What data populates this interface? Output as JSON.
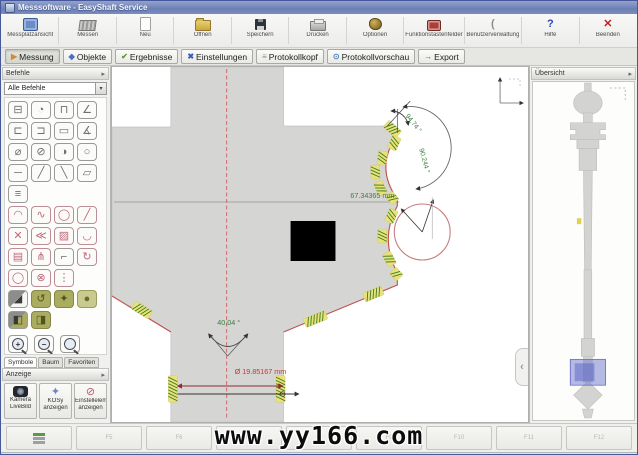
{
  "window": {
    "title": "Messsoftware - EasyShaft Service"
  },
  "toolbar": {
    "items": [
      {
        "id": "messplatzansicht",
        "label": "Messplatzansicht",
        "icon": "monitor"
      },
      {
        "id": "messen",
        "label": "Messen",
        "icon": "ruler"
      },
      {
        "id": "neu",
        "label": "Neu",
        "icon": "page"
      },
      {
        "id": "oeffnen",
        "label": "Öffnen",
        "icon": "folder"
      },
      {
        "id": "speichern",
        "label": "Speichern",
        "icon": "floppy"
      },
      {
        "id": "drucken",
        "label": "Drucken",
        "icon": "printer"
      },
      {
        "id": "optionen",
        "label": "Optionen",
        "icon": "gear"
      },
      {
        "id": "funktionstastenfelder",
        "label": "Funktionstastenfelder",
        "icon": "keypad"
      },
      {
        "id": "benutzerverwaltung",
        "label": "Benutzerverwaltung",
        "icon": "user",
        "glyph": "(",
        "gcls": "g-user"
      },
      {
        "id": "hilfe",
        "label": "Hilfe",
        "icon": "help",
        "glyph": "?",
        "gcls": "g-help"
      },
      {
        "id": "beenden",
        "label": "Beenden",
        "icon": "exit",
        "glyph": "✕",
        "gcls": "g-exit"
      }
    ]
  },
  "tabs": {
    "items": [
      {
        "id": "messung",
        "label": "Messung",
        "glyph": "▶",
        "color": "#cf8a3a",
        "active": true
      },
      {
        "id": "objekte",
        "label": "Objekte",
        "glyph": "◆",
        "color": "#4a6fc0",
        "active": false
      },
      {
        "id": "ergebnisse",
        "label": "Ergebnisse",
        "glyph": "✔",
        "color": "#5a9a3a",
        "active": false
      },
      {
        "id": "einstellungen",
        "label": "Einstellungen",
        "glyph": "✖",
        "color": "#3a5fc0",
        "active": false
      },
      {
        "id": "protokollkopf",
        "label": "Protokollkopf",
        "glyph": "≡",
        "color": "#8a8a88",
        "active": false
      },
      {
        "id": "protokollvorschau",
        "label": "Protokollvorschau",
        "glyph": "⊙",
        "color": "#4a7fc0",
        "active": false
      },
      {
        "id": "export",
        "label": "Export",
        "glyph": "→",
        "color": "#c03a2a",
        "active": false
      }
    ]
  },
  "sidebar": {
    "commands_header": "Befehle",
    "commands_filter": "Alle Befehle",
    "tools": [
      {
        "name": "caliper",
        "glyph": "⊟"
      },
      {
        "name": "circle-sector",
        "glyph": "◔"
      },
      {
        "name": "width",
        "glyph": "⊓"
      },
      {
        "name": "angle",
        "glyph": "∠"
      },
      {
        "name": "outer-distance",
        "glyph": "⊏"
      },
      {
        "name": "inner-distance",
        "glyph": "⊐"
      },
      {
        "name": "rectangle",
        "glyph": "▭"
      },
      {
        "name": "angle-3p",
        "glyph": "∡"
      },
      {
        "name": "circle-diameter",
        "glyph": "⌀"
      },
      {
        "name": "circle-slash",
        "glyph": "⊘"
      },
      {
        "name": "circle-gauge",
        "glyph": "◑"
      },
      {
        "name": "circle",
        "glyph": "○"
      },
      {
        "name": "line-horizontal",
        "glyph": "─"
      },
      {
        "name": "line-diagonal",
        "glyph": "╱"
      },
      {
        "name": "line-2p",
        "glyph": "╲"
      },
      {
        "name": "plane",
        "glyph": "▱"
      },
      {
        "name": "ellipse-scan",
        "glyph": "≡"
      },
      {
        "blank": true
      },
      {
        "blank": true
      },
      {
        "blank": true
      },
      {
        "name": "arc",
        "glyph": "◠",
        "tint": "pink"
      },
      {
        "name": "spline",
        "glyph": "∿",
        "tint": "pink"
      },
      {
        "name": "circle-construct",
        "glyph": "◯",
        "tint": "pink"
      },
      {
        "name": "line-construct",
        "glyph": "╱",
        "tint": "pink"
      },
      {
        "name": "intersection",
        "glyph": "✕",
        "tint": "pink"
      },
      {
        "name": "line-fan",
        "glyph": "≪",
        "tint": "pink"
      },
      {
        "name": "hatch",
        "glyph": "▨",
        "tint": "pink"
      },
      {
        "name": "curve",
        "glyph": "◡",
        "tint": "pink"
      },
      {
        "name": "table",
        "glyph": "▤",
        "tint": "pink"
      },
      {
        "name": "tree",
        "glyph": "⋔",
        "tint": "pink"
      },
      {
        "name": "corner",
        "glyph": "⌐"
      },
      {
        "name": "rotate",
        "glyph": "↻",
        "tint": "pink"
      },
      {
        "name": "ellipse",
        "glyph": "◯",
        "tint": "pink"
      },
      {
        "name": "crossed-circle",
        "glyph": "⊗",
        "tint": "pink"
      },
      {
        "name": "point-list",
        "glyph": "⋮",
        "tint": "pink"
      },
      {
        "blank": true
      },
      {
        "name": "fill-corner",
        "glyph": "◢",
        "tint": "split"
      },
      {
        "name": "refresh-olive",
        "glyph": "↺",
        "tint": "olive"
      },
      {
        "name": "shape-olive",
        "glyph": "✦",
        "tint": "olive"
      },
      {
        "name": "blob-olive",
        "glyph": "●",
        "tint": "olight"
      },
      {
        "name": "half-dark",
        "glyph": "◧",
        "tint": "splito"
      },
      {
        "name": "half-olive",
        "glyph": "◨",
        "tint": "olive"
      },
      {
        "blank": true
      },
      {
        "blank": true
      }
    ],
    "zoom_tools": [
      {
        "name": "zoom-in",
        "sign": "+"
      },
      {
        "name": "zoom-out",
        "sign": "−"
      },
      {
        "name": "zoom-region",
        "sign": ""
      }
    ],
    "monitor_tool": {
      "name": "view-display"
    },
    "bottom_tabs": [
      {
        "id": "symbole",
        "label": "Symbole",
        "active": true
      },
      {
        "id": "baum",
        "label": "Baum",
        "active": false
      },
      {
        "id": "favoriten",
        "label": "Favoriten",
        "active": false
      }
    ],
    "display_header": "Anzeige",
    "display_buttons": [
      {
        "name": "kamera-livebild",
        "lines": [
          "Kamera",
          "LiveBild"
        ],
        "icon": "cam"
      },
      {
        "name": "kosy-anzeigen",
        "lines": [
          "KOSy",
          "anzeigen"
        ],
        "icon": "kos",
        "glyph": "✦"
      },
      {
        "name": "einstellelemente-anzeigen",
        "lines": [
          "Einstellelemente",
          "anzeigen"
        ],
        "icon": "ein",
        "glyph": "⊘"
      }
    ]
  },
  "canvas": {
    "dimensions": {
      "width_label": "67.34365 mm",
      "angle_chamfer": "94.74 °",
      "angle_arc": "90.244 °",
      "angle_bottom": "40.04 °",
      "diameter_label": "Ø 19.85167 mm"
    },
    "colors": {
      "part_fill": "#d5d5d3",
      "measured_edge": "#c0504a",
      "probe_band": "#e9e27b",
      "probe_tick": "#3f7a23",
      "dimension_green": "#3e7d3e",
      "dimension_red": "#c0392b"
    }
  },
  "overview": {
    "header": "Übersicht"
  },
  "bottombar": {
    "buttons": [
      {
        "id": "layers",
        "label": "",
        "icon": "stack"
      },
      {
        "id": "f5",
        "label": "F5"
      },
      {
        "id": "f6",
        "label": "F6"
      },
      {
        "id": "f7",
        "label": "F7"
      },
      {
        "id": "f8",
        "label": "F8"
      },
      {
        "id": "f9",
        "label": "F9"
      },
      {
        "id": "f10",
        "label": "F10"
      },
      {
        "id": "f11",
        "label": "F11"
      },
      {
        "id": "f12",
        "label": "F12"
      }
    ],
    "watermark": "www.yy166.com"
  }
}
